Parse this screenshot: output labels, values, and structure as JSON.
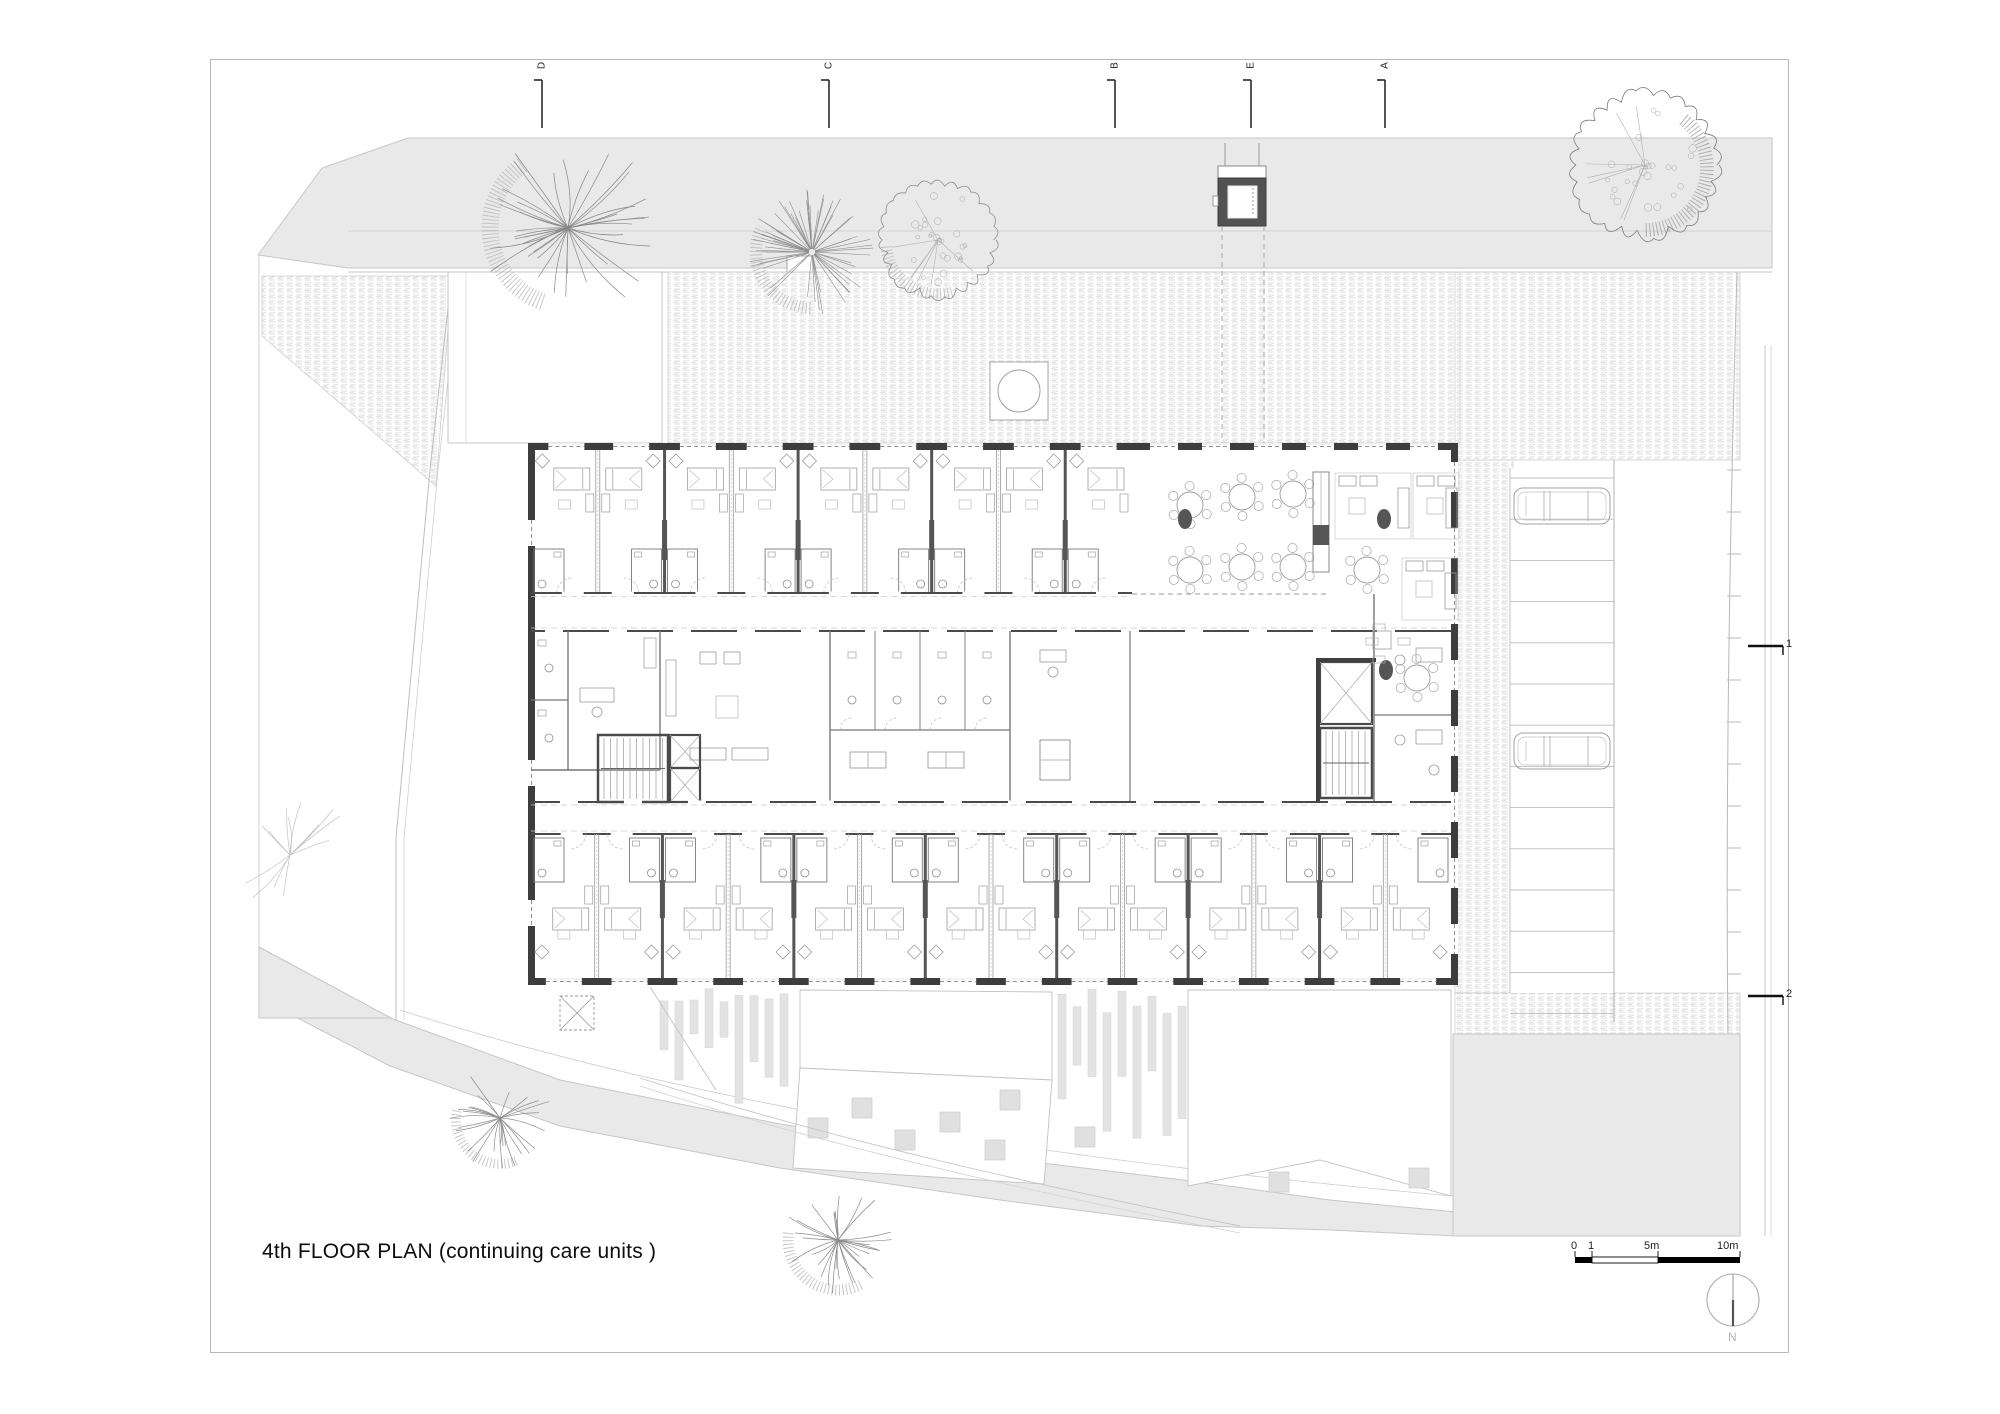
{
  "page": {
    "background": "#ffffff",
    "border_color": "#b8b8b8"
  },
  "title": {
    "text": "4th FLOOR PLAN (continuing care units )"
  },
  "drawing": {
    "type": "architectural-floor-plan",
    "floor": "4th",
    "program": "continuing care units",
    "grid_markers": [
      {
        "label": "D"
      },
      {
        "label": "C"
      },
      {
        "label": "B"
      },
      {
        "label": "E"
      },
      {
        "label": "A"
      }
    ],
    "section_markers": [
      {
        "label": "1"
      },
      {
        "label": "2"
      }
    ],
    "north": {
      "label": "N"
    },
    "scale_bar": {
      "labels": [
        "0",
        "1",
        "5m",
        "10m"
      ]
    },
    "rooms": {
      "top_count": 9,
      "bottom_count": 14,
      "dining_round_tables": 7,
      "parking_stalls": 13,
      "cars": 2
    },
    "colors": {
      "site": "#e9e9e9",
      "site_line": "#c6c6c6",
      "stipple": "#dcdcdc",
      "wall": "#3d3d3d",
      "wall_mid": "#4a4a4a",
      "partition": "#909090",
      "furniture": "#9c9c9c",
      "dark": "#525252",
      "bars": "#e3e3e3",
      "tree": "#8d8d8d",
      "tree_faint": "#c2c2c2",
      "text": "#111111"
    }
  }
}
